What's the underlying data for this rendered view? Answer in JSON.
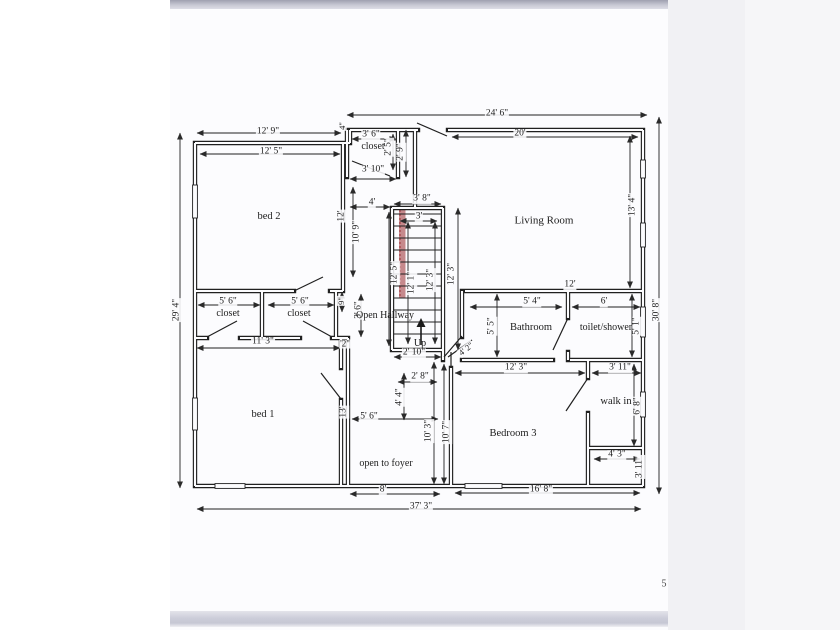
{
  "page": {
    "number": "5"
  },
  "colors": {
    "outer_bg": "#ffffff",
    "page_bg": "#fcfcfe",
    "right_margin_bg": "#f1f1f4",
    "right_margin2_bg": "#f6f6f8",
    "wall": "#202020",
    "stair_highlight": "#c6898c",
    "stair_highlight_edge": "#a03a3f"
  },
  "floor_plan": {
    "rooms": [
      "bed 2",
      "Living Room",
      "closet",
      "closet",
      "closet",
      "Open Hallway",
      "Bathroom",
      "toilet/shower",
      "bed 1",
      "Bedroom 3",
      "walk in"
    ],
    "annotations": [
      "Up",
      "open to foyer"
    ],
    "overall_dimensions": {
      "top": "24' 6\"",
      "bottom": "37' 3\"",
      "left": "29' 4\"",
      "right": "30' 8\""
    },
    "labels": [
      {
        "t": "12' 9\"",
        "x": 268,
        "y": 132,
        "n": "dim-bed2-top-outer"
      },
      {
        "t": "12' 5\"",
        "x": 271,
        "y": 152,
        "n": "dim-bed2-top-inner"
      },
      {
        "t": "24' 6\"",
        "x": 497,
        "y": 114,
        "n": "dim-overall-top"
      },
      {
        "t": "20'",
        "x": 520,
        "y": 134,
        "n": "dim-livingroom-top"
      },
      {
        "t": "3' 6\"",
        "x": 371,
        "y": 135,
        "n": "dim-closet-top"
      },
      {
        "t": "closet",
        "x": 373,
        "y": 147,
        "fs": 10,
        "n": "room-label-closet-top"
      },
      {
        "t": "2' 5\"",
        "x": 389,
        "y": 147,
        "r": -90,
        "n": "dim-closet-right"
      },
      {
        "t": "2' 9\"",
        "x": 401,
        "y": 152,
        "r": -90,
        "n": "dim-closet-nook"
      },
      {
        "t": "3' 10\"",
        "x": 373,
        "y": 170,
        "n": "dim-closet-bottom"
      },
      {
        "t": "4\"",
        "x": 342,
        "y": 126,
        "r": -90,
        "fs": 8.5,
        "n": "dim-wall-gap"
      },
      {
        "t": "4'",
        "x": 372,
        "y": 203,
        "n": "dim-hallway-width"
      },
      {
        "t": "3' 8\"",
        "x": 422,
        "y": 199,
        "n": "dim-stairs-top-outer"
      },
      {
        "t": "3'",
        "x": 419,
        "y": 217,
        "n": "dim-stairs-top-inner"
      },
      {
        "t": "10' 9\"",
        "x": 357,
        "y": 232,
        "r": -90,
        "n": "dim-hallway-height"
      },
      {
        "t": "12'",
        "x": 342,
        "y": 216,
        "r": -90,
        "n": "dim-bed2-right"
      },
      {
        "t": "12' 5\"",
        "x": 395,
        "y": 273,
        "r": -90,
        "n": "dim-stairs-left-outer"
      },
      {
        "t": "12' 1\"",
        "x": 412,
        "y": 283,
        "r": -90,
        "n": "dim-stairs-left-inner"
      },
      {
        "t": "12' 3\"",
        "x": 431,
        "y": 280,
        "r": -90,
        "n": "dim-stairs-right-inner"
      },
      {
        "t": "12' 3\"",
        "x": 452,
        "y": 274,
        "r": -90,
        "n": "dim-stairs-right-outer"
      },
      {
        "t": "13' 4\"",
        "x": 633,
        "y": 205,
        "r": -90,
        "n": "dim-livingroom-right"
      },
      {
        "t": "29' 4\"",
        "x": 177,
        "y": 310,
        "r": -90,
        "n": "dim-overall-left"
      },
      {
        "t": "30' 8\"",
        "x": 657,
        "y": 310,
        "r": -90,
        "n": "dim-overall-right"
      },
      {
        "t": "Living Room",
        "x": 544,
        "y": 221,
        "fs": 11,
        "room": true,
        "n": "room-label-living-room"
      },
      {
        "t": "bed 2",
        "x": 269,
        "y": 217,
        "fs": 10.5,
        "room": true,
        "n": "room-label-bed-2"
      },
      {
        "t": "5' 6\"",
        "x": 228,
        "y": 302,
        "n": "dim-closet1-width"
      },
      {
        "t": "closet",
        "x": 228,
        "y": 314,
        "fs": 10,
        "n": "room-label-closet-1"
      },
      {
        "t": "5' 6\"",
        "x": 300,
        "y": 302,
        "n": "dim-closet2-width"
      },
      {
        "t": "closet",
        "x": 299,
        "y": 314,
        "fs": 10,
        "n": "room-label-closet-2"
      },
      {
        "t": "9\"",
        "x": 341,
        "y": 301,
        "r": -90,
        "fs": 8.5,
        "n": "dim-stub"
      },
      {
        "t": "3' 6\"",
        "x": 359,
        "y": 310,
        "r": -90,
        "n": "dim-hallway-lower"
      },
      {
        "t": "Open Hallway",
        "x": 385,
        "y": 316,
        "fs": 10,
        "room": true,
        "n": "room-label-open-hallway"
      },
      {
        "t": "11' 3\"",
        "x": 263,
        "y": 342,
        "n": "dim-closet-row-bottom"
      },
      {
        "t": "'2\"",
        "x": 345,
        "y": 344,
        "fs": 9,
        "n": "dim-partial"
      },
      {
        "t": "Up",
        "x": 420,
        "y": 344,
        "fs": 10,
        "room": true,
        "n": "stairs-up-label"
      },
      {
        "t": "2' 10\"",
        "x": 414,
        "y": 353,
        "n": "dim-stairs-bottom"
      },
      {
        "t": "4' 2\"",
        "x": 466,
        "y": 349,
        "r": -38,
        "fs": 8.5,
        "n": "dim-entry-door"
      },
      {
        "t": "12'",
        "x": 570,
        "y": 285,
        "n": "dim-bath-block-top"
      },
      {
        "t": "5' 4\"",
        "x": 532,
        "y": 302,
        "n": "dim-bathroom-width"
      },
      {
        "t": "6'",
        "x": 604,
        "y": 302,
        "n": "dim-toilet-width"
      },
      {
        "t": "5' 5\"",
        "x": 492,
        "y": 326,
        "r": -90,
        "n": "dim-bathroom-height"
      },
      {
        "t": "Bathroom",
        "x": 531,
        "y": 328,
        "fs": 10.5,
        "room": true,
        "n": "room-label-bathroom"
      },
      {
        "t": "toilet/shower",
        "x": 606,
        "y": 328,
        "fs": 10,
        "room": true,
        "n": "room-label-toilet-shower"
      },
      {
        "t": "5' 1\"",
        "x": 637,
        "y": 326,
        "r": -90,
        "n": "dim-toilet-height"
      },
      {
        "t": "12' 3\"",
        "x": 516,
        "y": 368,
        "n": "dim-bedroom3-top"
      },
      {
        "t": "3' 11\"",
        "x": 620,
        "y": 368,
        "n": "dim-walkin-top"
      },
      {
        "t": "bed 1",
        "x": 263,
        "y": 415,
        "fs": 10.5,
        "room": true,
        "n": "room-label-bed-1"
      },
      {
        "t": "13'",
        "x": 344,
        "y": 412,
        "r": -90,
        "n": "dim-foyer-wall"
      },
      {
        "t": "5' 6\"",
        "x": 369,
        "y": 417,
        "n": "dim-foyer-width"
      },
      {
        "t": "4' 4\"",
        "x": 400,
        "y": 397,
        "r": -90,
        "n": "dim-landing-height"
      },
      {
        "t": "2' 8\"",
        "x": 420,
        "y": 377,
        "n": "dim-landing-width"
      },
      {
        "t": "10' 3\"",
        "x": 429,
        "y": 431,
        "r": -90,
        "n": "dim-foyer-height"
      },
      {
        "t": "10' 7\"",
        "x": 447,
        "y": 432,
        "r": -90,
        "n": "dim-bedroom3-left"
      },
      {
        "t": "open to foyer",
        "x": 386,
        "y": 464,
        "fs": 10,
        "room": true,
        "n": "room-label-open-to-foyer"
      },
      {
        "t": "Bedroom 3",
        "x": 513,
        "y": 434,
        "fs": 10.5,
        "room": true,
        "n": "room-label-bedroom-3"
      },
      {
        "t": "walk in",
        "x": 616,
        "y": 402,
        "fs": 10.5,
        "room": true,
        "n": "room-label-walk-in"
      },
      {
        "t": "6' 8\"",
        "x": 638,
        "y": 406,
        "r": -90,
        "n": "dim-walkin-height"
      },
      {
        "t": "4' 3\"",
        "x": 617,
        "y": 455,
        "n": "dim-nook-width"
      },
      {
        "t": "3' 11\"",
        "x": 640,
        "y": 467,
        "r": -90,
        "n": "dim-nook-height"
      },
      {
        "t": "8'",
        "x": 383,
        "y": 490,
        "n": "dim-foyer-bottom"
      },
      {
        "t": "16' 8\"",
        "x": 541,
        "y": 490,
        "n": "dim-bedroom3-bottom"
      },
      {
        "t": "37' 3\"",
        "x": 421,
        "y": 507,
        "n": "dim-overall-bottom"
      }
    ]
  }
}
